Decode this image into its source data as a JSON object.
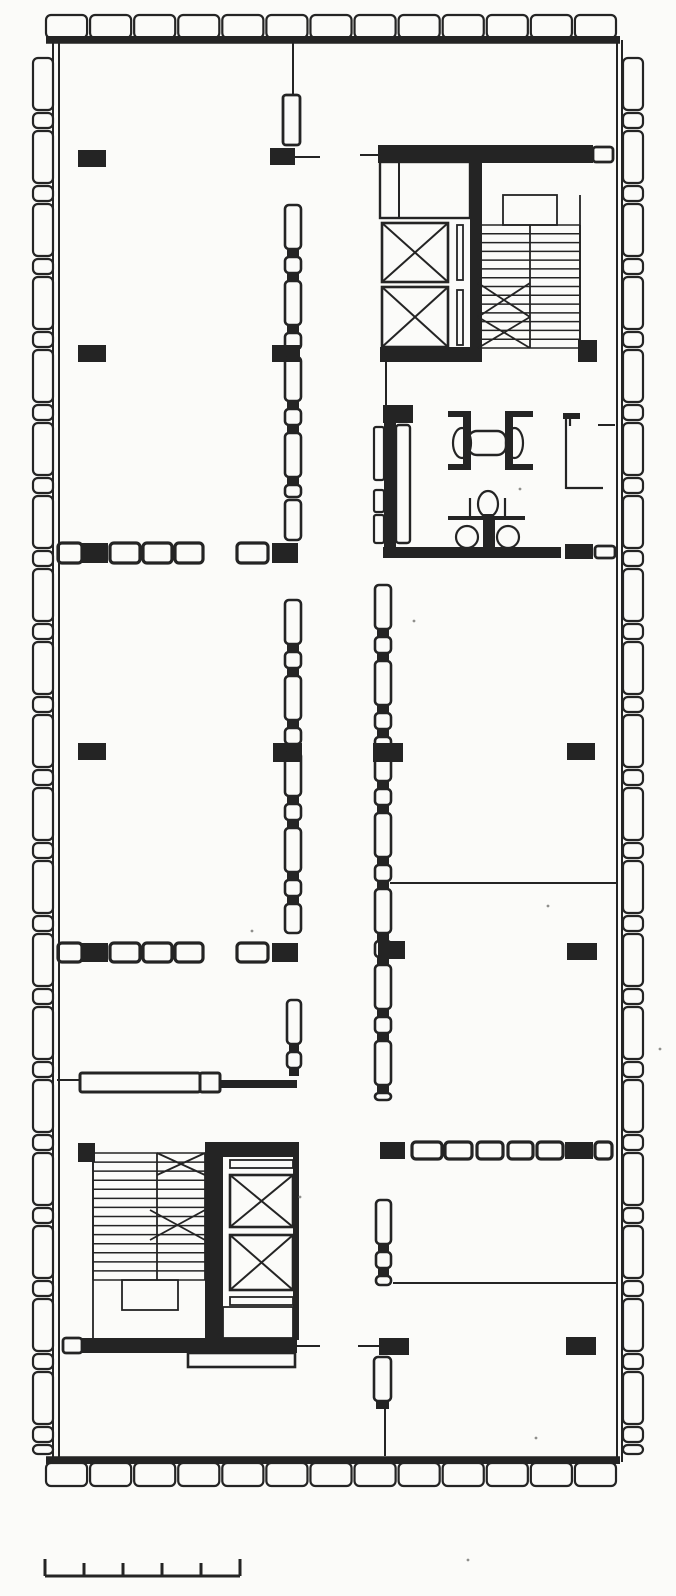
{
  "title": "Scanned architectural floor plan — rectangular office tower typical floor with two elevator/stair cores, restroom block, demountable partitions, perimeter window modules and graphic scale bar",
  "plan": {
    "paper": "#fbfbf9",
    "ink": "#242424",
    "speck_color": "#8f8f8c",
    "walls": {
      "top_bar": [
        46,
        36,
        574,
        7
      ],
      "bottom_bar": [
        46,
        1457,
        574,
        7
      ],
      "top_line": [
        46,
        43,
        620,
        43
      ],
      "bottom_line": [
        46,
        1457,
        620,
        1457
      ],
      "left_lines": [
        [
          53,
          40,
          53,
          1462
        ],
        [
          59,
          43,
          59,
          1458
        ]
      ],
      "right_lines": [
        [
          617,
          43,
          617,
          1458
        ],
        [
          622,
          40,
          622,
          1462
        ]
      ]
    },
    "window_modules": [
      {
        "edge": "top",
        "x0": 46,
        "x1": 616,
        "y": 15,
        "t": 23,
        "n": 13,
        "gap": 3
      },
      {
        "edge": "bottom",
        "x0": 46,
        "x1": 616,
        "y": 1463,
        "t": 23,
        "n": 13,
        "gap": 3
      },
      {
        "edge": "left",
        "x": 33,
        "t": 20,
        "y0": 58,
        "y1": 1454,
        "pattern": [
          52,
          15
        ],
        "gap": 3
      },
      {
        "edge": "right",
        "x": 623,
        "t": 20,
        "y0": 58,
        "y1": 1454,
        "pattern": [
          52,
          15
        ],
        "gap": 3
      }
    ],
    "columns": [
      [
        78,
        150,
        28,
        17
      ],
      [
        78,
        345,
        28,
        17
      ],
      [
        78,
        743,
        28,
        17
      ],
      [
        270,
        148,
        25,
        17
      ],
      [
        272,
        345,
        28,
        17
      ],
      [
        273,
        743,
        29,
        19
      ],
      [
        373,
        743,
        30,
        19
      ],
      [
        383,
        405,
        30,
        18
      ],
      [
        378,
        941,
        27,
        18
      ],
      [
        567,
        743,
        28,
        17
      ],
      [
        567,
        943,
        30,
        17
      ],
      [
        566,
        1337,
        30,
        18
      ],
      [
        379,
        1338,
        30,
        17
      ],
      [
        578,
        340,
        19,
        22
      ]
    ],
    "door_rows": [
      {
        "y": 543,
        "h": 20,
        "segs": [
          [
            58,
            24,
            "p"
          ],
          [
            82,
            26,
            "b"
          ],
          [
            110,
            30,
            "p"
          ],
          [
            143,
            29,
            "p"
          ],
          [
            175,
            28,
            "p"
          ],
          [
            237,
            31,
            "p"
          ],
          [
            272,
            26,
            "b"
          ]
        ]
      },
      {
        "y": 943,
        "h": 19,
        "segs": [
          [
            58,
            24,
            "p"
          ],
          [
            82,
            26,
            "b"
          ],
          [
            110,
            30,
            "p"
          ],
          [
            143,
            29,
            "p"
          ],
          [
            175,
            28,
            "p"
          ],
          [
            237,
            31,
            "p"
          ],
          [
            272,
            26,
            "b"
          ]
        ]
      },
      {
        "y": 1142,
        "h": 17,
        "segs": [
          [
            380,
            25,
            "b"
          ],
          [
            412,
            30,
            "p"
          ],
          [
            445,
            27,
            "p"
          ],
          [
            477,
            26,
            "p"
          ],
          [
            508,
            25,
            "p"
          ],
          [
            537,
            26,
            "p"
          ],
          [
            565,
            28,
            "b"
          ],
          [
            595,
            17,
            "p"
          ]
        ]
      }
    ],
    "partitions": [
      {
        "x": 285,
        "w": 16,
        "y0": 205,
        "y1": 497
      },
      {
        "x": 285,
        "w": 16,
        "y0": 500,
        "y1": 540
      },
      {
        "x": 285,
        "w": 16,
        "y0": 600,
        "y1": 933
      },
      {
        "x": 287,
        "w": 14,
        "y0": 1000,
        "y1": 1075
      },
      {
        "x": 375,
        "w": 16,
        "y0": 585,
        "y1": 1100
      },
      {
        "x": 376,
        "w": 15,
        "y0": 1200,
        "y1": 1285
      },
      {
        "x": 374,
        "w": 17,
        "y0": 1357,
        "y1": 1408
      }
    ],
    "panels": [
      [
        283,
        95,
        17,
        50
      ],
      [
        63,
        1338,
        19,
        15
      ],
      [
        593,
        147,
        20,
        15
      ],
      [
        595,
        546,
        20,
        12
      ]
    ],
    "counter": {
      "body": [
        80,
        1073,
        120,
        19
      ],
      "box": [
        200,
        1073,
        20,
        19
      ],
      "bar": [
        220,
        1080,
        77,
        8
      ]
    },
    "lines": [
      [
        293,
        42,
        293,
        95
      ],
      [
        295,
        157,
        320,
        157
      ],
      [
        360,
        155,
        378,
        155
      ],
      [
        386,
        362,
        386,
        405
      ],
      [
        390,
        883,
        617,
        883
      ],
      [
        393,
        1283,
        617,
        1283
      ],
      [
        598,
        425,
        615,
        425
      ],
      [
        358,
        1346,
        379,
        1346
      ],
      [
        297,
        1346,
        320,
        1346
      ],
      [
        385,
        1408,
        385,
        1456
      ],
      [
        57,
        1080,
        80,
        1080
      ]
    ],
    "core_top_right": {
      "top_bar": [
        378,
        145,
        215,
        18
      ],
      "vwall": [
        470,
        163,
        12,
        199
      ],
      "bottom_bar": [
        380,
        347,
        98,
        15
      ],
      "machine_room": [
        380,
        162,
        90,
        56
      ],
      "machine_div": [
        399,
        162,
        399,
        218
      ],
      "elevators": [
        [
          382,
          223,
          66,
          59
        ],
        [
          382,
          287,
          66,
          60
        ]
      ],
      "slots": [
        [
          457,
          225,
          6,
          55
        ],
        [
          457,
          290,
          6,
          55
        ]
      ],
      "stair": {
        "x0": 478,
        "x1": 580,
        "split": 530,
        "y0": 225,
        "y1": 348,
        "treads": 14,
        "landing": [
          503,
          195,
          54,
          30
        ],
        "edge_lines": [
          [
            580,
            195,
            580,
            348
          ]
        ],
        "diagonals": [
          [
            478,
            283,
            530,
            317
          ],
          [
            478,
            317,
            530,
            283
          ],
          [
            478,
            317,
            530,
            348
          ],
          [
            478,
            348,
            530,
            317
          ]
        ]
      }
    },
    "core_bottom_left": {
      "corner_block": [
        78,
        1143,
        17,
        19
      ],
      "stair": {
        "x0": 93,
        "x1": 205,
        "split": 157,
        "y0": 1153,
        "y1": 1280,
        "treads": 14,
        "landing": [
          122,
          1280,
          56,
          30
        ],
        "edge_lines": [
          [
            93,
            1153,
            93,
            1338
          ]
        ],
        "diagonals": [
          [
            157,
            1153,
            205,
            1175
          ],
          [
            157,
            1175,
            205,
            1153
          ],
          [
            150,
            1210,
            205,
            1240
          ],
          [
            150,
            1240,
            205,
            1210
          ]
        ]
      },
      "tower": {
        "west": [
          205,
          1142,
          18,
          198
        ],
        "top": [
          210,
          1142,
          88,
          15
        ],
        "east": [
          293,
          1142,
          6,
          198
        ],
        "slots": [
          [
            230,
            1160,
            63,
            8
          ],
          [
            230,
            1297,
            63,
            8
          ]
        ],
        "elevators": [
          [
            230,
            1175,
            63,
            52
          ],
          [
            230,
            1235,
            63,
            55
          ]
        ],
        "vestibule": [
          223,
          1307,
          70,
          31
        ]
      },
      "bottom_bar": [
        82,
        1338,
        215,
        15
      ],
      "lip": [
        188,
        1353,
        107,
        14
      ]
    },
    "restroom": {
      "west_panels": [
        [
          374,
          427,
          10,
          53
        ],
        [
          374,
          490,
          10,
          22
        ],
        [
          374,
          515,
          10,
          28
        ]
      ],
      "west_bar": [
        384,
        423,
        12,
        124
      ],
      "west_tall_panel": [
        396,
        425,
        14,
        118
      ],
      "sink_left_bracket": [
        [
          448,
          411,
          22,
          6
        ],
        [
          463,
          411,
          8,
          59
        ],
        [
          448,
          464,
          22,
          6
        ]
      ],
      "sink_right_bracket": [
        [
          505,
          411,
          28,
          6
        ],
        [
          505,
          411,
          8,
          59
        ],
        [
          505,
          464,
          28,
          6
        ]
      ],
      "basins": [
        [
          453,
          428,
          18,
          30
        ],
        [
          506,
          428,
          17,
          30
        ]
      ],
      "sink_center": [
        468,
        431,
        38,
        24
      ],
      "toilet_top": [
        478,
        491,
        20,
        26
      ],
      "toilet_tank": [
        483,
        514,
        11,
        7
      ],
      "rail": [
        448,
        516,
        77,
        4
      ],
      "rail_stubs": [
        [
          470,
          498,
          470,
          516
        ],
        [
          505,
          498,
          505,
          516
        ]
      ],
      "chase": [
        483,
        520,
        12,
        36
      ],
      "toilet_left": [
        456,
        526,
        22,
        22
      ],
      "toilet_right": [
        497,
        526,
        22,
        22
      ],
      "south_bar": [
        383,
        547,
        178,
        11
      ],
      "south_block": [
        565,
        544,
        28,
        15
      ],
      "lwall_lines": [
        [
          566,
          414,
          566,
          489
        ],
        [
          566,
          488,
          603,
          488
        ],
        [
          570,
          418,
          570,
          426
        ]
      ],
      "lwall_top": [
        563,
        413,
        17,
        6
      ]
    },
    "scale_bar": {
      "x0": 45,
      "x1": 240,
      "y": 1576,
      "ticks": [
        45,
        84,
        123,
        162,
        201,
        240
      ],
      "tick_h": 13,
      "end_h": 17
    },
    "specks": [
      [
        520,
        489
      ],
      [
        414,
        621
      ],
      [
        548,
        906
      ],
      [
        252,
        931
      ],
      [
        300,
        1197
      ],
      [
        536,
        1438
      ],
      [
        660,
        1049
      ],
      [
        468,
        1560
      ]
    ]
  }
}
